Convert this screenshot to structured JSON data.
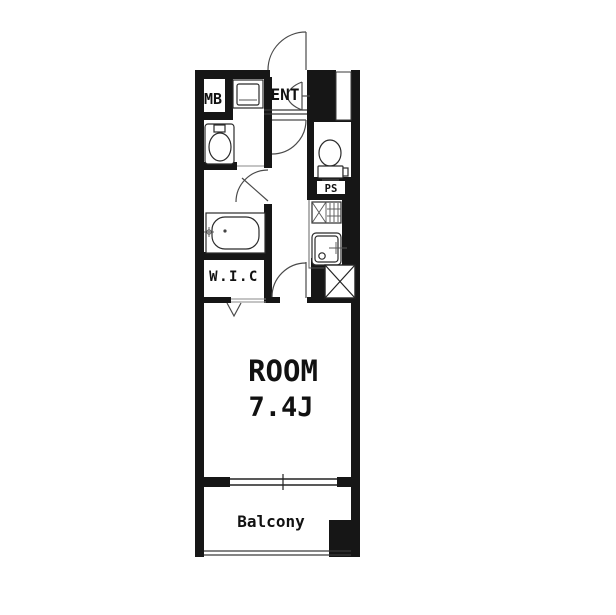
{
  "floorplan": {
    "type": "apartment-floor-plan",
    "colors": {
      "wall": "#161616",
      "background": "#ffffff",
      "line": "#3a3a3a"
    },
    "labels": {
      "mb": "MB",
      "ent": "ENT",
      "ps": "PS",
      "wic": "W.I.C",
      "room": "ROOM",
      "room_size": "7.4J",
      "balcony": "Balcony"
    },
    "fixtures": [
      "washing-machine-pan",
      "washbasin",
      "bathtub",
      "toilet",
      "gas-stove",
      "kitchen-sink",
      "duct-shaft-box",
      "entrance-door",
      "hall-door",
      "bath-door",
      "room-door",
      "wic-folding-door",
      "sliding-window"
    ]
  }
}
